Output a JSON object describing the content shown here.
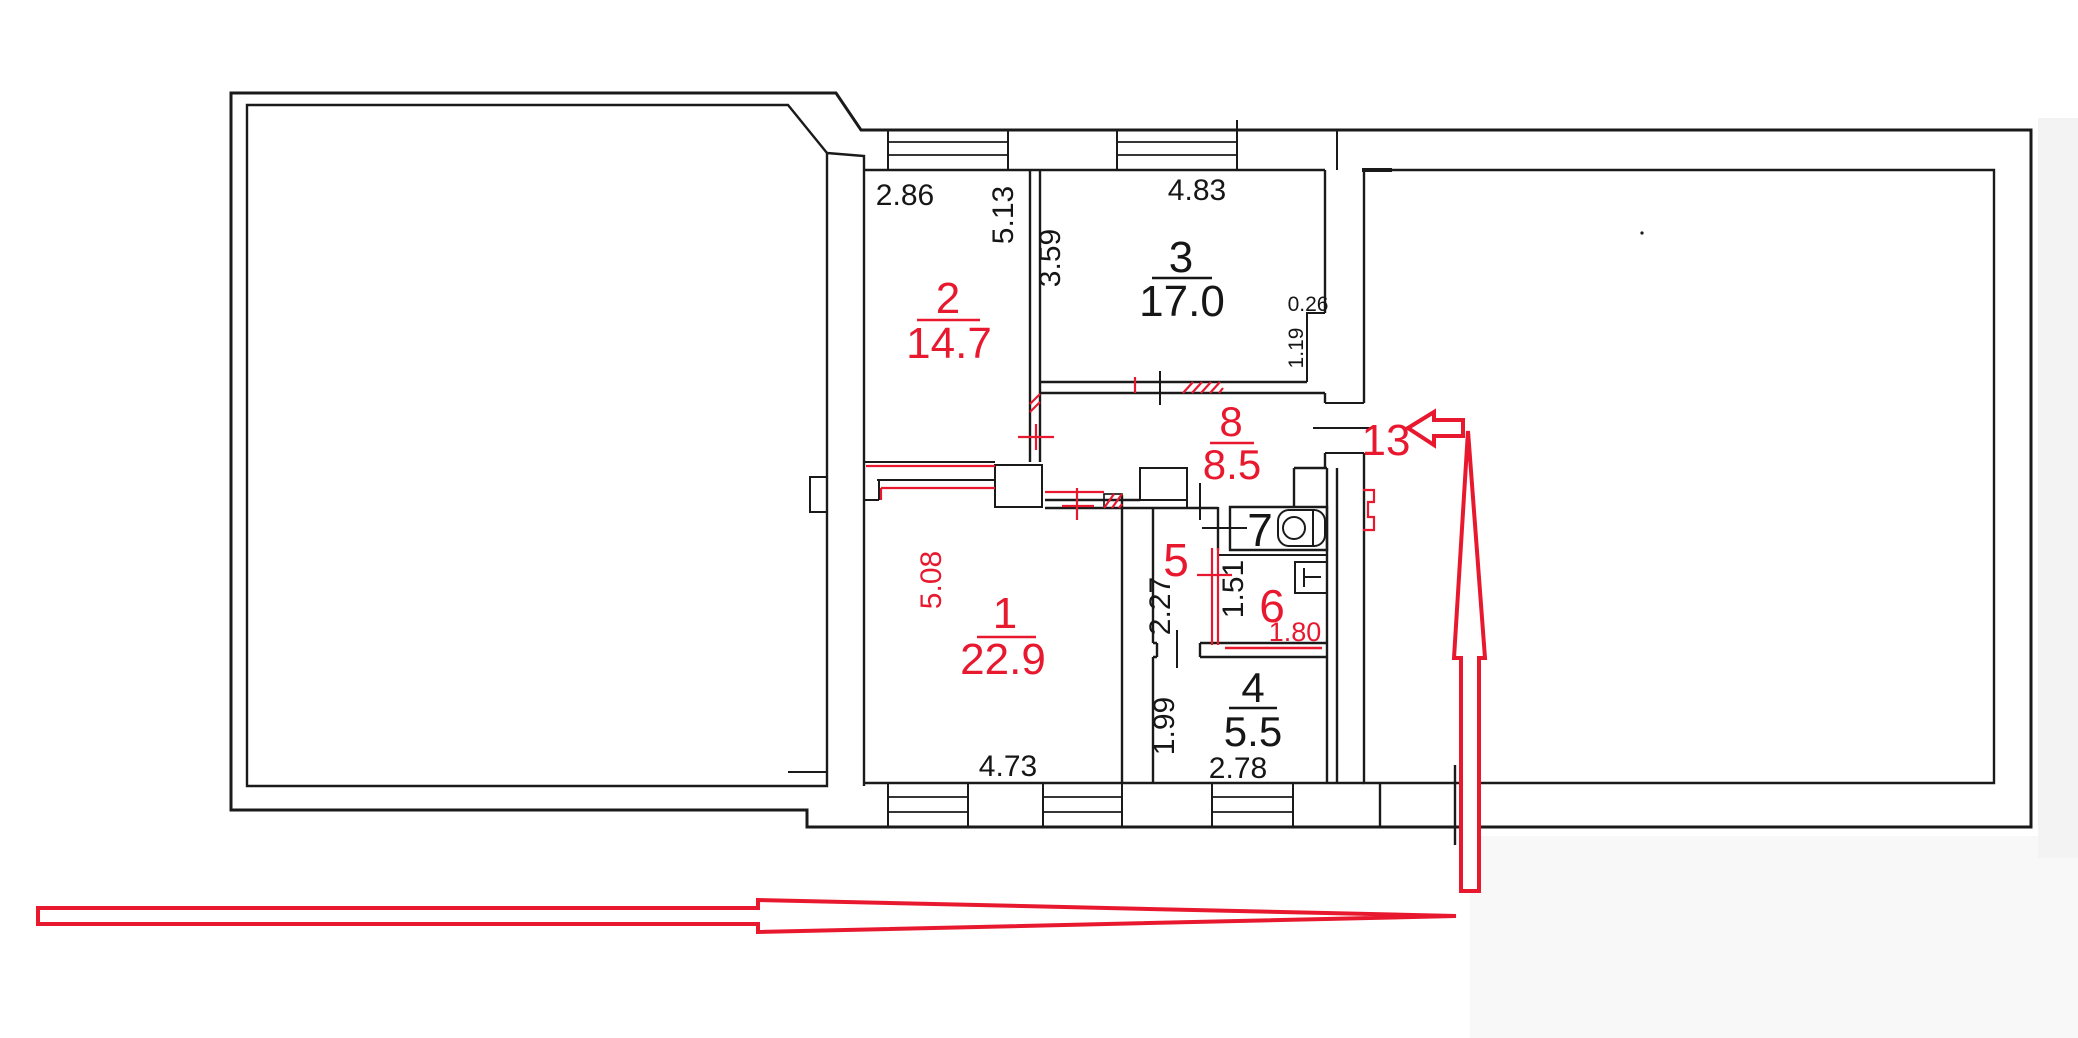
{
  "colors": {
    "wall": "#1a1a1a",
    "annotation_red": "#e8192f"
  },
  "rooms": [
    {
      "number": "1",
      "area": "22.9",
      "label_color": "red",
      "width_m": "4.73",
      "height_m": "5.08"
    },
    {
      "number": "2",
      "area": "14.7",
      "label_color": "red",
      "width_m": "2.86",
      "height_m": "5.13"
    },
    {
      "number": "3",
      "area": "17.0",
      "label_color": "black",
      "width_m": "4.83",
      "height_m": "3.59"
    },
    {
      "number": "4",
      "area": "5.5",
      "label_color": "black",
      "width_m": "2.78",
      "height_m": "1.99"
    },
    {
      "number": "5",
      "label_color": "red",
      "height_m": "2.27"
    },
    {
      "number": "6",
      "label_color": "red",
      "width_m": "1.80",
      "height_m": "1.51"
    },
    {
      "number": "7",
      "label_color": "black"
    },
    {
      "number": "8",
      "area": "8.5",
      "label_color": "red"
    }
  ],
  "niche": {
    "width_m": "0.26",
    "depth_m": "1.19"
  },
  "entrance": {
    "label": "13"
  }
}
